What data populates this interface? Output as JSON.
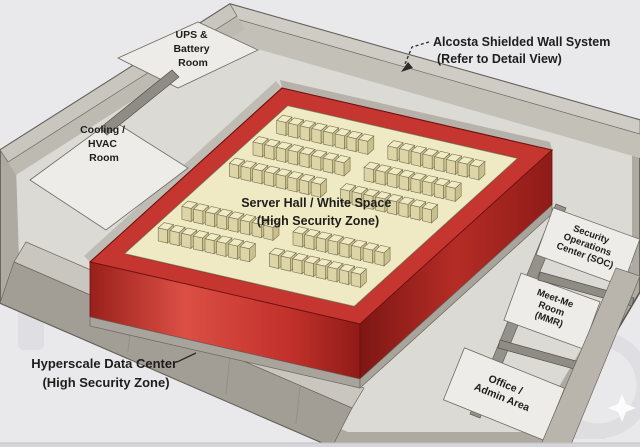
{
  "diagram": {
    "annotations": {
      "shield_wall": {
        "line1": "Alcosta Shielded Wall System",
        "line2": "(Refer to Detail View)"
      },
      "datacenter": {
        "line1": "Hyperscale Data Center",
        "line2": "(High Security Zone)"
      }
    },
    "rooms": {
      "ups": {
        "lines": [
          "UPS &",
          "Battery",
          "Room"
        ]
      },
      "hvac": {
        "lines": [
          "Cooling /",
          "HVAC",
          "Room"
        ]
      },
      "server_hall": {
        "lines": [
          "Server Hall / White Space",
          "(High Security Zone)"
        ]
      },
      "soc": {
        "lines": [
          "Security",
          "Operations",
          "Center (SOC)"
        ]
      },
      "mmr": {
        "lines": [
          "Meet-Me",
          "Room",
          "(MMR)"
        ]
      },
      "office": {
        "lines": [
          "Office /",
          "Admin Area"
        ]
      }
    },
    "colors": {
      "background": "#e9e9ec",
      "shield_wall_red": "#c63631",
      "server_floor_yellow": "#efeac3",
      "wall_gray": "#aeaaa2"
    }
  }
}
